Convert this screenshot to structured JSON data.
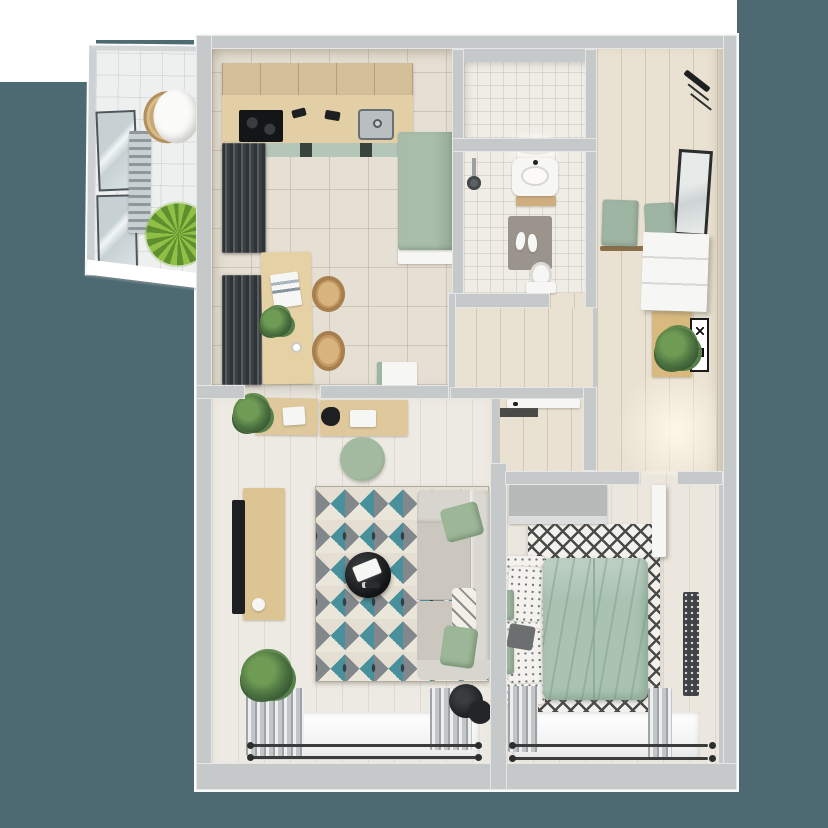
{
  "page": {
    "label": "3D rendered top-view floor plan of a one-bedroom apartment with balcony",
    "type": "architectural render, no visible text"
  },
  "palette": {
    "background_teal": "#4d6a73",
    "wall_gray": "#c6c9ca",
    "floor_tile": "#e6e0d4",
    "floor_wood": "#e9e1d1",
    "floor_light": "#edeae3",
    "wood_light": "#e2cfa5",
    "wood_cabinet": "#d2bf98",
    "sage_green": "#9fb5a3",
    "duvet_green": "#a9c2b2",
    "rug_teal": "#47909c",
    "rug_gray": "#82878b",
    "rug_cream": "#ebe6da",
    "dark": "#1d1f20",
    "plant_green": "#6f9c38"
  },
  "scene": {
    "rooms": [
      {
        "name": "Balcony",
        "items": [
          "glazed window panels",
          "slat radiator",
          "wicker chair",
          "palm plant",
          "white sill"
        ]
      },
      {
        "name": "Kitchen-Dining",
        "items": [
          "upper cabinets",
          "wood counter",
          "black cooktop",
          "steel sink",
          "green cabinet fronts",
          "tall sage fridge unit",
          "two dark radiator panels",
          "dining table",
          "two rattan chairs",
          "magazine",
          "table plant",
          "coffee cup",
          "white service cart"
        ]
      },
      {
        "name": "Bathroom",
        "items": [
          "shower room",
          "bathtub",
          "shower set",
          "washbasin with ring light",
          "wood shelf",
          "gray bath mat",
          "white slippers",
          "toilet"
        ]
      },
      {
        "name": "Entry Hall",
        "items": [
          "coat rack",
          "leaning mirror",
          "two sage bench cushions",
          "white shoe cabinet",
          "wood console",
          "plant",
          "framed XO art"
        ]
      },
      {
        "name": "Living Room",
        "items": [
          "desk with papers and bag",
          "desk plant",
          "sage desk chair",
          "tv board",
          "tv",
          "speaker",
          "geometric teal rug",
          "round black coffee table",
          "magazines",
          "sofa",
          "two sage pillows",
          "patterned pillow",
          "black floor lamp",
          "floor plant",
          "curtains",
          "window with double rod"
        ]
      },
      {
        "name": "Hallway",
        "items": [
          "interior door",
          "dark door mat"
        ]
      },
      {
        "name": "Bedroom",
        "items": [
          "gray dresser",
          "double bed with sage duvet",
          "dotted pillows",
          "folded blanket",
          "black-white diamond rug",
          "dark runner rug",
          "leaning picture frames",
          "open white door",
          "curtains",
          "window with double rod"
        ]
      }
    ]
  }
}
